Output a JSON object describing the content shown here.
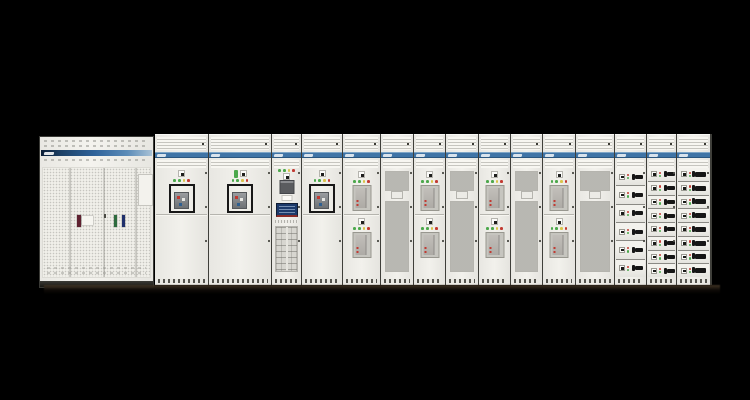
{
  "scene": {
    "type": "product-photograph",
    "subject": "low-voltage switchgear and motor control center lineup on black background",
    "background": "#000000"
  },
  "palette": {
    "cabinet_face": "#f2f1ec",
    "panel_line": "#c2c1bb",
    "banner_blue": "#3f74a6",
    "banner_blue_dark": "#2a567f",
    "banner_blue_light": "#7fa5c6",
    "left_banner_gradient": [
      "#0b1e36",
      "#2f639a",
      "#a9c2d6"
    ],
    "mesh_fill": "#d2d1cb",
    "led_green": "#4ca84c",
    "led_yellow": "#d9c34a",
    "led_red": "#c23a32",
    "breaker_frame": "#181818",
    "breaker_label_blue": "#3f72a8",
    "hmi_screen": "#1c3a6b",
    "hmi_accent_red": "#8a2c28",
    "handle_black": "#161616",
    "shadow": "#16120d"
  },
  "left_cabinet": {
    "name": "perforated-door distribution cabinet",
    "door_labels": [
      {
        "name": "maroon-label",
        "color": "#5e2130",
        "w": 4,
        "h": 12,
        "x": 34,
        "y": 47
      },
      {
        "name": "white-label",
        "color": "#f6f5f0",
        "w": 11,
        "h": 9,
        "x": 39,
        "y": 48
      },
      {
        "name": "green-label",
        "color": "#2e6b3e",
        "w": 3,
        "h": 12,
        "x": 71,
        "y": 47
      },
      {
        "name": "navy-label",
        "color": "#20306b",
        "w": 3,
        "h": 12,
        "x": 79,
        "y": 47
      }
    ]
  },
  "lineup": {
    "led_colors": [
      "#4ca84c",
      "#4ca84c",
      "#d9c34a",
      "#c23a32"
    ],
    "drawer_led_colors": [
      "#c23a32",
      "#4ca84c"
    ],
    "pilot_green": "#4ca84c",
    "sections": [
      {
        "id": "acb-1",
        "type": "acb",
        "width": 53
      },
      {
        "id": "acb-2",
        "type": "acb",
        "width": 62,
        "pilot": true
      },
      {
        "id": "metering-hmi",
        "type": "hmi",
        "width": 29
      },
      {
        "id": "acb-3",
        "type": "acb",
        "width": 40
      },
      {
        "id": "mccb-1",
        "type": "mccb2",
        "width": 37
      },
      {
        "id": "mesh-1",
        "type": "mesh",
        "width": 32
      },
      {
        "id": "mccb-2",
        "type": "mccb2",
        "width": 31
      },
      {
        "id": "mesh-2",
        "type": "mesh",
        "width": 32
      },
      {
        "id": "mccb-3",
        "type": "mccb2",
        "width": 31
      },
      {
        "id": "mesh-3",
        "type": "mesh",
        "width": 31
      },
      {
        "id": "mccb-4",
        "type": "mccb2",
        "width": 32
      },
      {
        "id": "mesh-4",
        "type": "mesh",
        "width": 38
      },
      {
        "id": "drawers-1",
        "type": "drawers",
        "width": 31,
        "rows": 6,
        "handle": "small"
      },
      {
        "id": "drawers-2",
        "type": "drawers",
        "width": 29,
        "rows": 8,
        "handle": "small"
      },
      {
        "id": "drawers-3",
        "type": "drawers",
        "width": 33,
        "rows": 8,
        "handle": "wide"
      }
    ]
  }
}
